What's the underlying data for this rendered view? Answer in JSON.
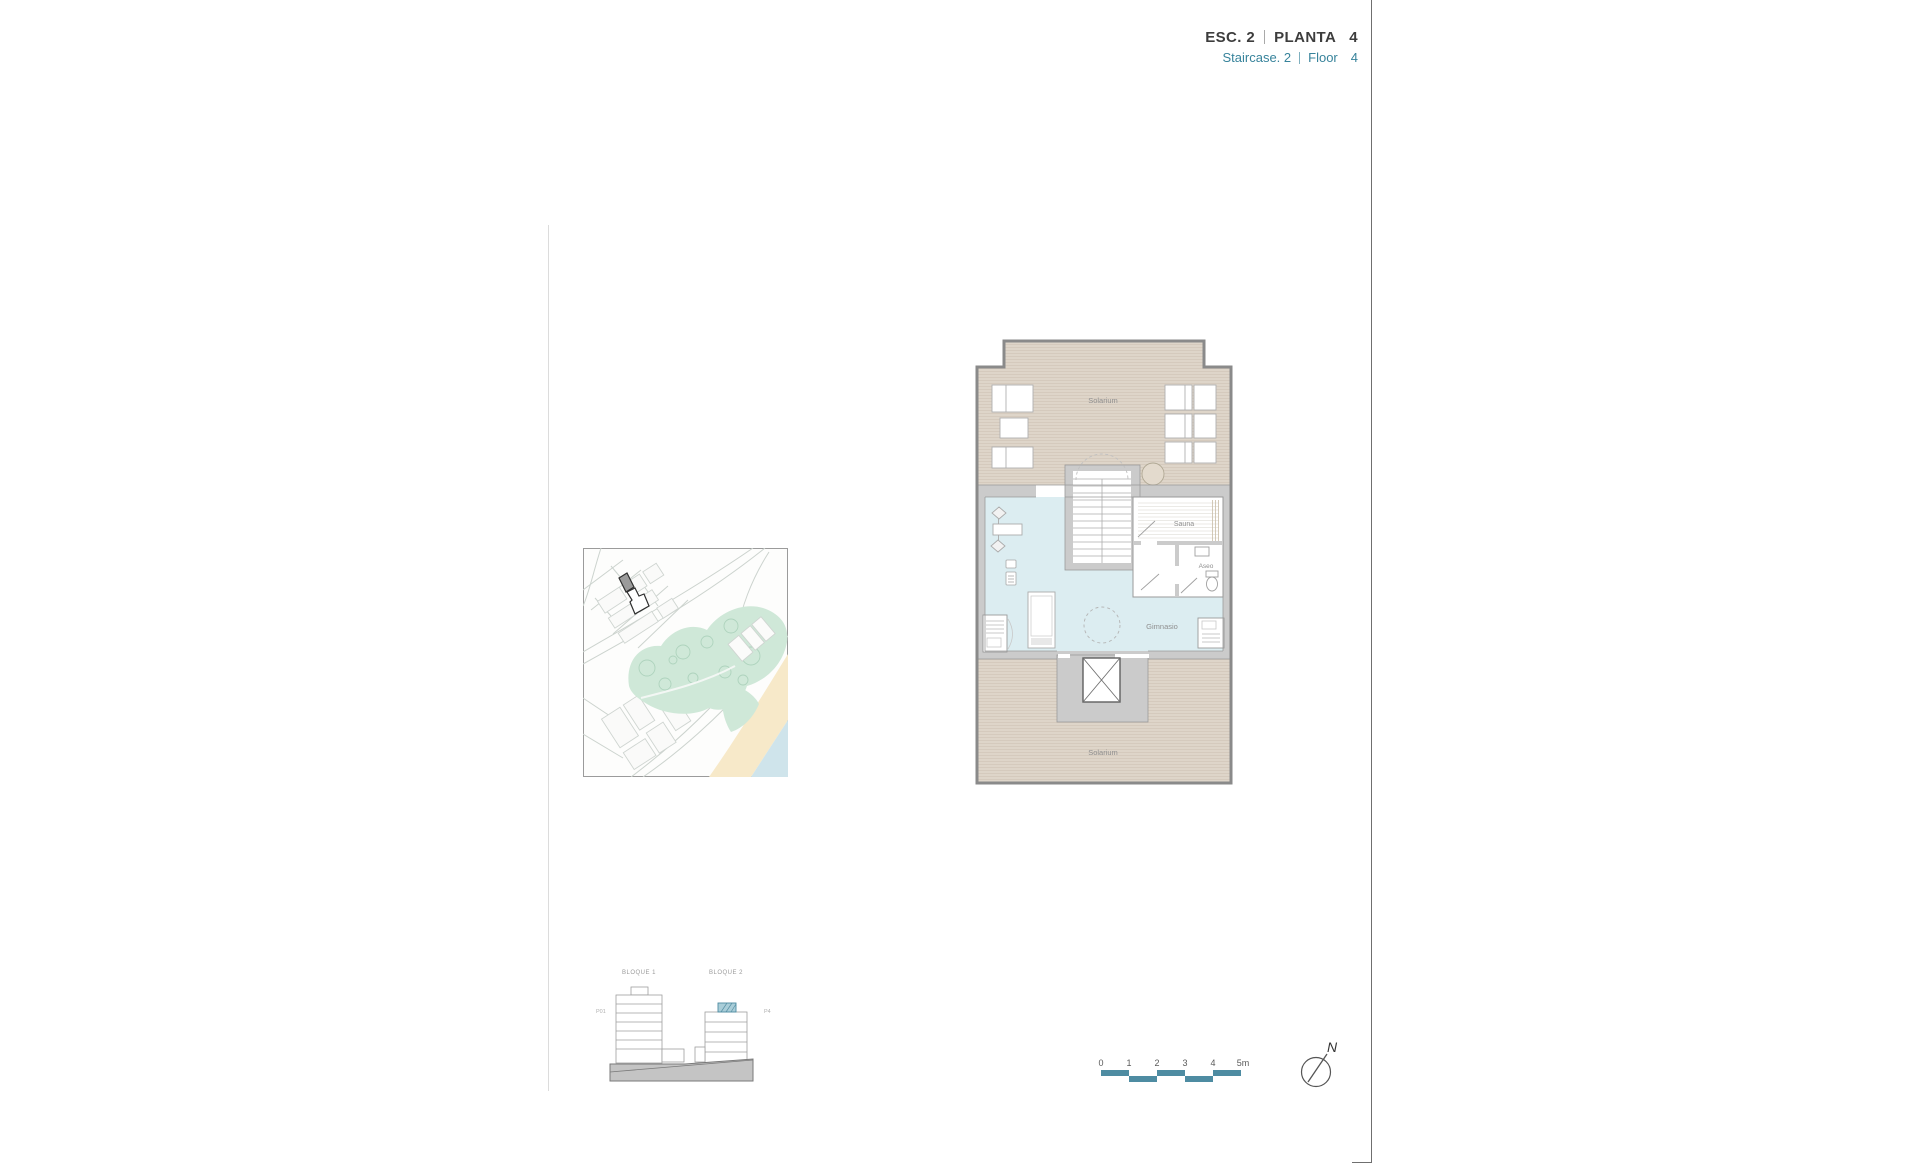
{
  "header": {
    "esc_label": "ESC. 2",
    "planta_label": "PLANTA",
    "planta_value": "4",
    "staircase_label": "Staircase. 2",
    "floor_label": "Floor",
    "floor_value": "4"
  },
  "floor_plan": {
    "rooms": {
      "solarium_upper": "Solarium",
      "sauna": "Sauna",
      "aseo": "Aseo",
      "gimnasio": "Gimnasio",
      "solarium_lower": "Solarium"
    }
  },
  "elevation": {
    "block1": "BLOQUE 1",
    "block2": "BLOQUE 2",
    "level_left": "P01",
    "level_right": "P4"
  },
  "scale_bar": {
    "ticks": [
      "0",
      "1",
      "2",
      "3",
      "4",
      "5m"
    ]
  },
  "north": {
    "label": "N"
  },
  "colors": {
    "accent_teal": "#37839B",
    "scale_teal": "#4E8CA2",
    "solarium_beige": "#DED5C9",
    "gym_blue": "#DCEDF1",
    "wall_gray": "#CBCBCB",
    "park_green": "#CFE8D8",
    "sand": "#F7E9C9",
    "sea": "#CFE4EB",
    "highlight_building": "#9B9B9B"
  }
}
